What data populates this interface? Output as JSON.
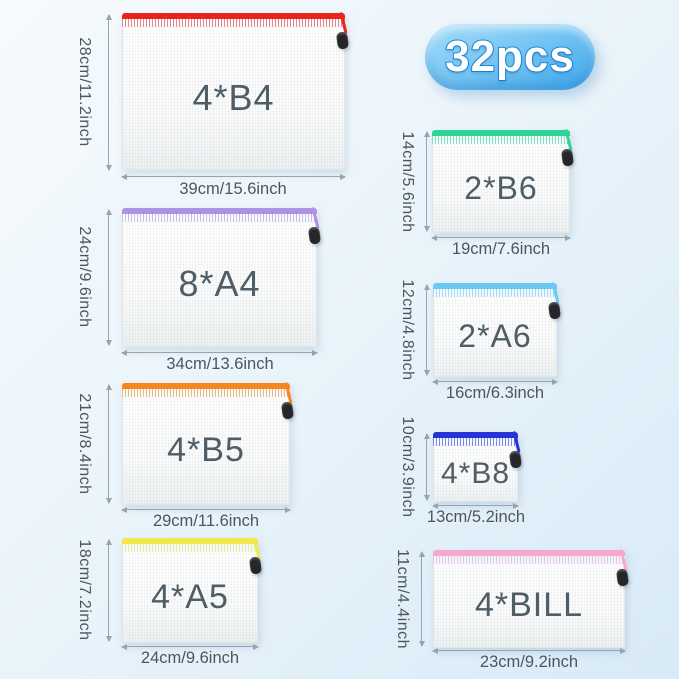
{
  "badge": {
    "label": "32pcs",
    "fill_top": "#a6dcf9",
    "fill_bottom": "#41a7ec",
    "text_color": "#ffffff",
    "outline_color": "#1d87d8"
  },
  "bags": [
    {
      "label": "4*B4",
      "height_label": "28cm/11.2inch",
      "width_label": "39cm/15.6inch",
      "zipper_color": "#e8251c"
    },
    {
      "label": "8*A4",
      "height_label": "24cm/9.6inch",
      "width_label": "34cm/13.6inch",
      "zipper_color": "#ad93e2"
    },
    {
      "label": "4*B5",
      "height_label": "21cm/8.4inch",
      "width_label": "29cm/11.6inch",
      "zipper_color": "#f6871d"
    },
    {
      "label": "4*A5",
      "height_label": "18cm/7.2inch",
      "width_label": "24cm/9.6inch",
      "zipper_color": "#f2e84e"
    },
    {
      "label": "2*B6",
      "height_label": "14cm/5.6inch",
      "width_label": "19cm/7.6inch",
      "zipper_color": "#2ed491"
    },
    {
      "label": "2*A6",
      "height_label": "12cm/4.8inch",
      "width_label": "16cm/6.3inch",
      "zipper_color": "#6cc8f0"
    },
    {
      "label": "4*B8",
      "height_label": "10cm/3.9inch",
      "width_label": "13cm/5.2inch",
      "zipper_color": "#2733d6"
    },
    {
      "label": "4*BILL",
      "height_label": "11cm/4.4inch",
      "width_label": "23cm/9.2inch",
      "zipper_color": "#f6a9cc"
    }
  ]
}
